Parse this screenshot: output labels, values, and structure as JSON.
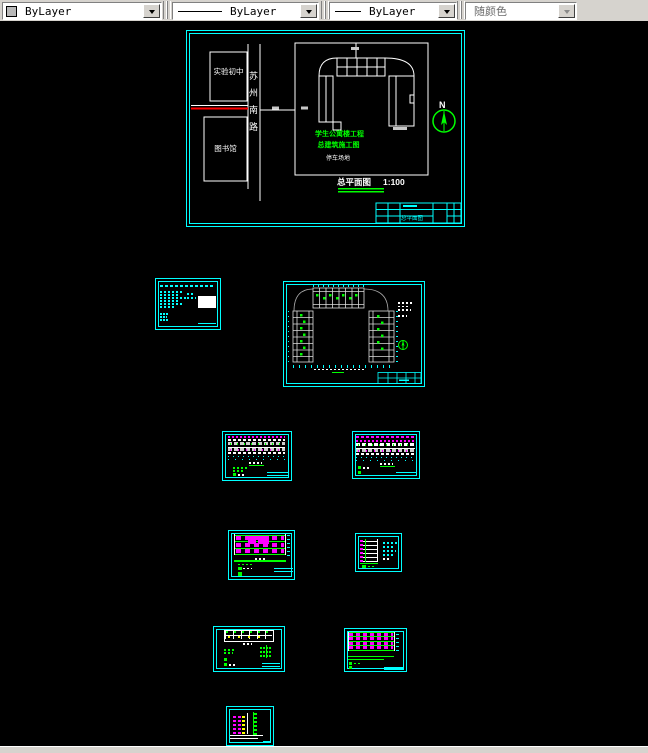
{
  "toolbar": {
    "color_combo": {
      "value": "ByLayer"
    },
    "linetype_combo": {
      "value": "ByLayer"
    },
    "lineweight_combo": {
      "value": "ByLayer"
    },
    "plotstyle_combo": {
      "value": "随颜色"
    }
  },
  "colors": {
    "frame": "#00ffff",
    "annotation": "#00ff00",
    "detail": "#ff00ff",
    "road_axis": "#ff0000"
  },
  "drawings": {
    "site_plan": {
      "school_label": "实验初中",
      "library_label": "图书馆",
      "road_name": "苏州南路",
      "project_line1": "学生公寓楼工程",
      "project_line2": "总建筑施工图",
      "parking_label": "停车场地",
      "north_label": "N",
      "caption": "总平面图",
      "scale": "1:100",
      "titleblock_label": "总平面图"
    }
  }
}
